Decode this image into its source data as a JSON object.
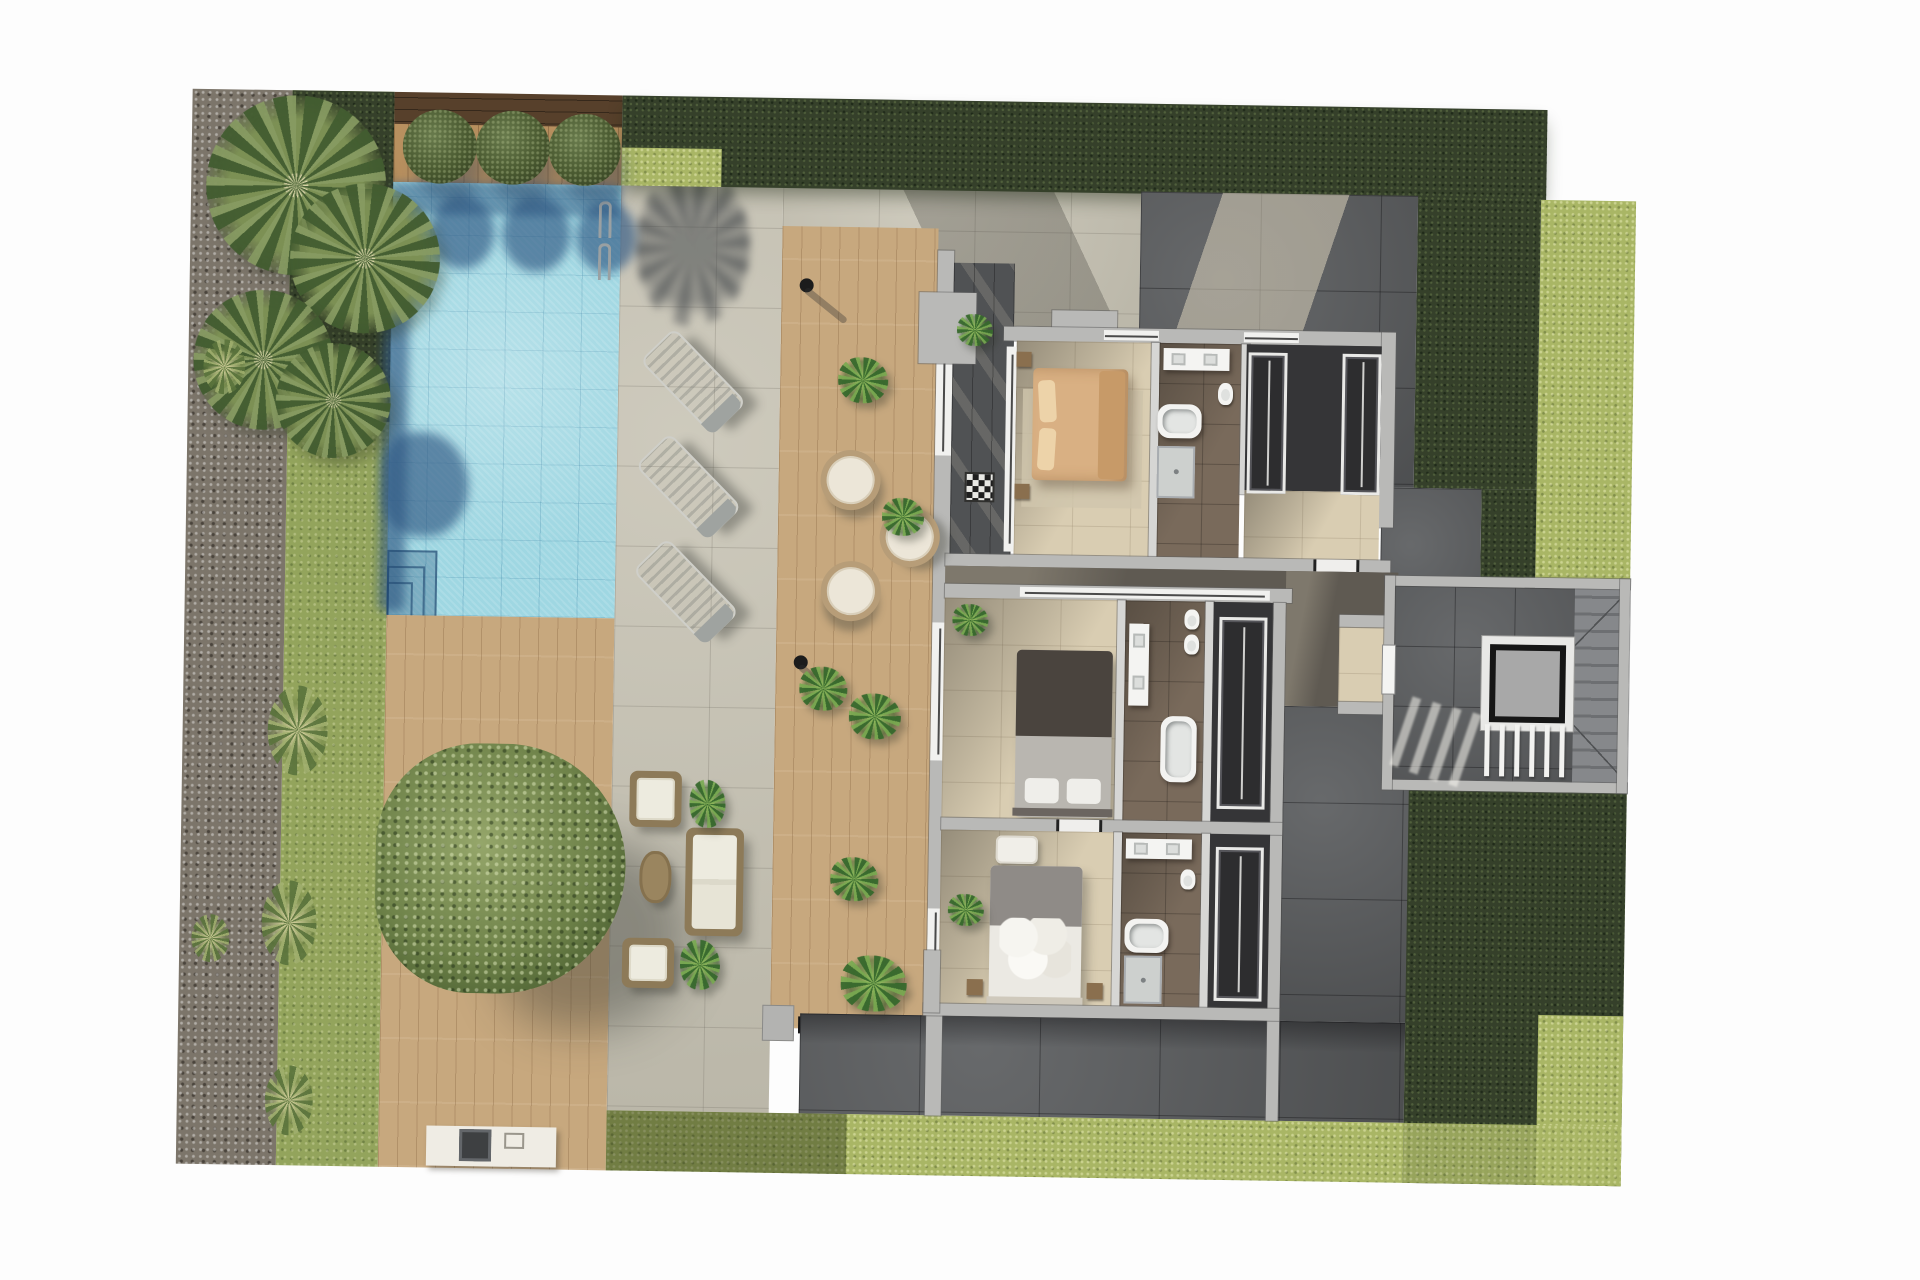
{
  "meta": {
    "title": "villa-first-floor-plan-top-view-render",
    "kind": "architectural-3d-floor-plan"
  },
  "palette": {
    "pageBg": "#fdfdfd",
    "grass": "#93a45c",
    "grassBright": "#a9b665",
    "hedge": "#35402a",
    "hedgeShade": "#2a3420",
    "gravel": "#7c756a",
    "woodDark": "#57402b",
    "woodInset": "#b8905f",
    "deck": "#c7a87e",
    "patio": "#c8c4b5",
    "paveDark": "#5e6062",
    "water": "#9fd7e2",
    "waterShadow": "rgba(47,88,130,0.65)",
    "wall": "#b9b9b7",
    "glassWhite": "#f1f1ef",
    "floorBeige": "#d9cdb2",
    "floorBath": "#796a5b",
    "floorDark": "#353537",
    "hall": "#5f5a52",
    "bedTan": "#d9b083",
    "bedGray": "#b9b6b0",
    "bedWhite": "#ebe9e3",
    "elevatorCar": "#a8a8a8"
  },
  "scene": {
    "objects": [
      {
        "type": "palm",
        "name": "palm-tree-1",
        "x": 15,
        "y": 5,
        "w": 180,
        "h": 180
      },
      {
        "type": "palm",
        "name": "palm-tree-2",
        "x": 100,
        "y": 92,
        "w": 150,
        "h": 150
      },
      {
        "type": "palm",
        "name": "palm-tree-3",
        "x": 5,
        "y": 200,
        "w": 140,
        "h": 140
      },
      {
        "type": "palm",
        "name": "palm-tree-4",
        "x": 88,
        "y": 252,
        "w": 115,
        "h": 115
      },
      {
        "type": "tuft",
        "name": "grass-tuft-1",
        "x": 85,
        "y": 595,
        "w": 60,
        "h": 90
      },
      {
        "type": "tuft",
        "name": "grass-tuft-2",
        "x": 82,
        "y": 790,
        "w": 55,
        "h": 85
      },
      {
        "type": "tuft",
        "name": "grass-tuft-3",
        "x": 88,
        "y": 975,
        "w": 48,
        "h": 70
      },
      {
        "type": "tuft",
        "name": "grass-tuft-4",
        "x": 15,
        "y": 250,
        "w": 42,
        "h": 55
      },
      {
        "type": "tuft",
        "name": "grass-tuft-5",
        "x": 12,
        "y": 825,
        "w": 38,
        "h": 48
      },
      {
        "type": "bush",
        "name": "round-bush-1",
        "x": 211,
        "y": 17,
        "w": 74,
        "h": 74
      },
      {
        "type": "bush",
        "name": "round-bush-2",
        "x": 284,
        "y": 17,
        "w": 74,
        "h": 74
      },
      {
        "type": "bush",
        "name": "round-bush-3",
        "x": 357,
        "y": 19,
        "w": 72,
        "h": 72
      },
      {
        "type": "tree",
        "name": "garden-tree",
        "x": 195,
        "y": 650,
        "w": 250,
        "h": 250
      },
      {
        "type": "lounger",
        "name": "sun-lounger-1",
        "x": 481,
        "y": 233,
        "w": 44,
        "h": 100,
        "rot": -45
      },
      {
        "type": "lounger",
        "name": "sun-lounger-2",
        "x": 478,
        "y": 338,
        "w": 44,
        "h": 100,
        "rot": -45
      },
      {
        "type": "lounger",
        "name": "sun-lounger-3",
        "x": 477,
        "y": 443,
        "w": 44,
        "h": 100,
        "rot": -45
      },
      {
        "type": "chair",
        "name": "wicker-chair-1",
        "x": 634,
        "y": 351,
        "w": 48,
        "h": 48,
        "rot": 15
      },
      {
        "type": "chair",
        "name": "wicker-chair-2",
        "x": 694,
        "y": 407,
        "w": 48,
        "h": 48,
        "rot": -25
      },
      {
        "type": "chair",
        "name": "wicker-chair-3",
        "x": 636,
        "y": 462,
        "w": 48,
        "h": 48,
        "rot": 40
      },
      {
        "type": "lamp",
        "name": "deck-lamp-1",
        "x": 610,
        "y": 180,
        "w": 14,
        "h": 14
      },
      {
        "type": "lamp",
        "name": "deck-lamp-2",
        "x": 610,
        "y": 557,
        "w": 14,
        "h": 14
      },
      {
        "type": "plant",
        "name": "deck-plant-1",
        "x": 650,
        "y": 258,
        "w": 50,
        "h": 46
      },
      {
        "type": "plant",
        "name": "deck-plant-2",
        "x": 696,
        "y": 398,
        "w": 42,
        "h": 38
      },
      {
        "type": "plant",
        "name": "deck-plant-3",
        "x": 616,
        "y": 568,
        "w": 48,
        "h": 44
      },
      {
        "type": "plant",
        "name": "deck-plant-4",
        "x": 666,
        "y": 594,
        "w": 52,
        "h": 46
      },
      {
        "type": "plant",
        "name": "deck-plant-5",
        "x": 650,
        "y": 758,
        "w": 48,
        "h": 44
      },
      {
        "type": "plant",
        "name": "deck-plant-6",
        "x": 662,
        "y": 856,
        "w": 66,
        "h": 56
      },
      {
        "type": "plant",
        "name": "terrace-plant-1",
        "x": 768,
        "y": 213,
        "w": 36,
        "h": 32
      },
      {
        "type": "plant",
        "name": "terrace-plant-2",
        "x": 768,
        "y": 503,
        "w": 36,
        "h": 32
      },
      {
        "type": "plant",
        "name": "terrace-plant-3",
        "x": 768,
        "y": 793,
        "w": 36,
        "h": 32
      },
      {
        "type": "mat",
        "name": "checkered-doormat",
        "x": 780,
        "y": 373,
        "w": 26,
        "h": 26
      },
      {
        "type": "armchair",
        "name": "lounge-armchair",
        "x": 448,
        "y": 675,
        "w": 52,
        "h": 56
      },
      {
        "type": "sofa",
        "name": "lounge-sofa",
        "x": 505,
        "y": 731,
        "w": 58,
        "h": 108
      },
      {
        "type": "pouf",
        "name": "lounge-pouf",
        "x": 443,
        "y": 842,
        "w": 52,
        "h": 50
      },
      {
        "type": "wtable",
        "name": "lounge-coffee-table",
        "x": 459,
        "y": 755,
        "w": 32,
        "h": 52
      },
      {
        "type": "plant",
        "name": "lounge-plant-1",
        "x": 508,
        "y": 683,
        "w": 36,
        "h": 48
      },
      {
        "type": "plant",
        "name": "lounge-plant-2",
        "x": 501,
        "y": 843,
        "w": 40,
        "h": 50
      },
      {
        "type": "wardrobe",
        "name": "dressing-wardrobe-left",
        "x": 1060,
        "y": 247,
        "w": 33,
        "h": 135
      },
      {
        "type": "wardrobe",
        "name": "dressing-wardrobe-right",
        "x": 1154,
        "y": 247,
        "w": 33,
        "h": 135
      },
      {
        "type": "wardrobe",
        "name": "closet2-wardrobe",
        "x": 1035,
        "y": 512,
        "w": 42,
        "h": 186
      },
      {
        "type": "wardrobe",
        "name": "closet3-wardrobe",
        "x": 1035,
        "y": 742,
        "w": 42,
        "h": 148
      },
      {
        "type": "slat",
        "name": "stair-railing-slat-1",
        "x": 1302,
        "y": 615,
        "w": 5,
        "h": 52
      },
      {
        "type": "slat",
        "name": "stair-railing-slat-2",
        "x": 1317,
        "y": 615,
        "w": 5,
        "h": 52
      },
      {
        "type": "slat",
        "name": "stair-railing-slat-3",
        "x": 1332,
        "y": 615,
        "w": 5,
        "h": 52
      },
      {
        "type": "slat",
        "name": "stair-railing-slat-4",
        "x": 1347,
        "y": 615,
        "w": 5,
        "h": 52
      },
      {
        "type": "slat",
        "name": "stair-railing-slat-5",
        "x": 1362,
        "y": 615,
        "w": 5,
        "h": 52
      },
      {
        "type": "slat",
        "name": "stair-railing-slat-6",
        "x": 1377,
        "y": 615,
        "w": 5,
        "h": 52
      },
      {
        "type": "streak",
        "name": "stair-light-streak-1",
        "x": 1218,
        "y": 588,
        "w": 9,
        "h": 72,
        "rot": 18
      },
      {
        "type": "streak",
        "name": "stair-light-streak-2",
        "x": 1238,
        "y": 593,
        "w": 9,
        "h": 74,
        "rot": 18
      },
      {
        "type": "streak",
        "name": "stair-light-streak-3",
        "x": 1258,
        "y": 598,
        "w": 9,
        "h": 76,
        "rot": 18
      },
      {
        "type": "streak",
        "name": "stair-light-streak-4",
        "x": 1278,
        "y": 603,
        "w": 9,
        "h": 76,
        "rot": 18
      }
    ]
  }
}
